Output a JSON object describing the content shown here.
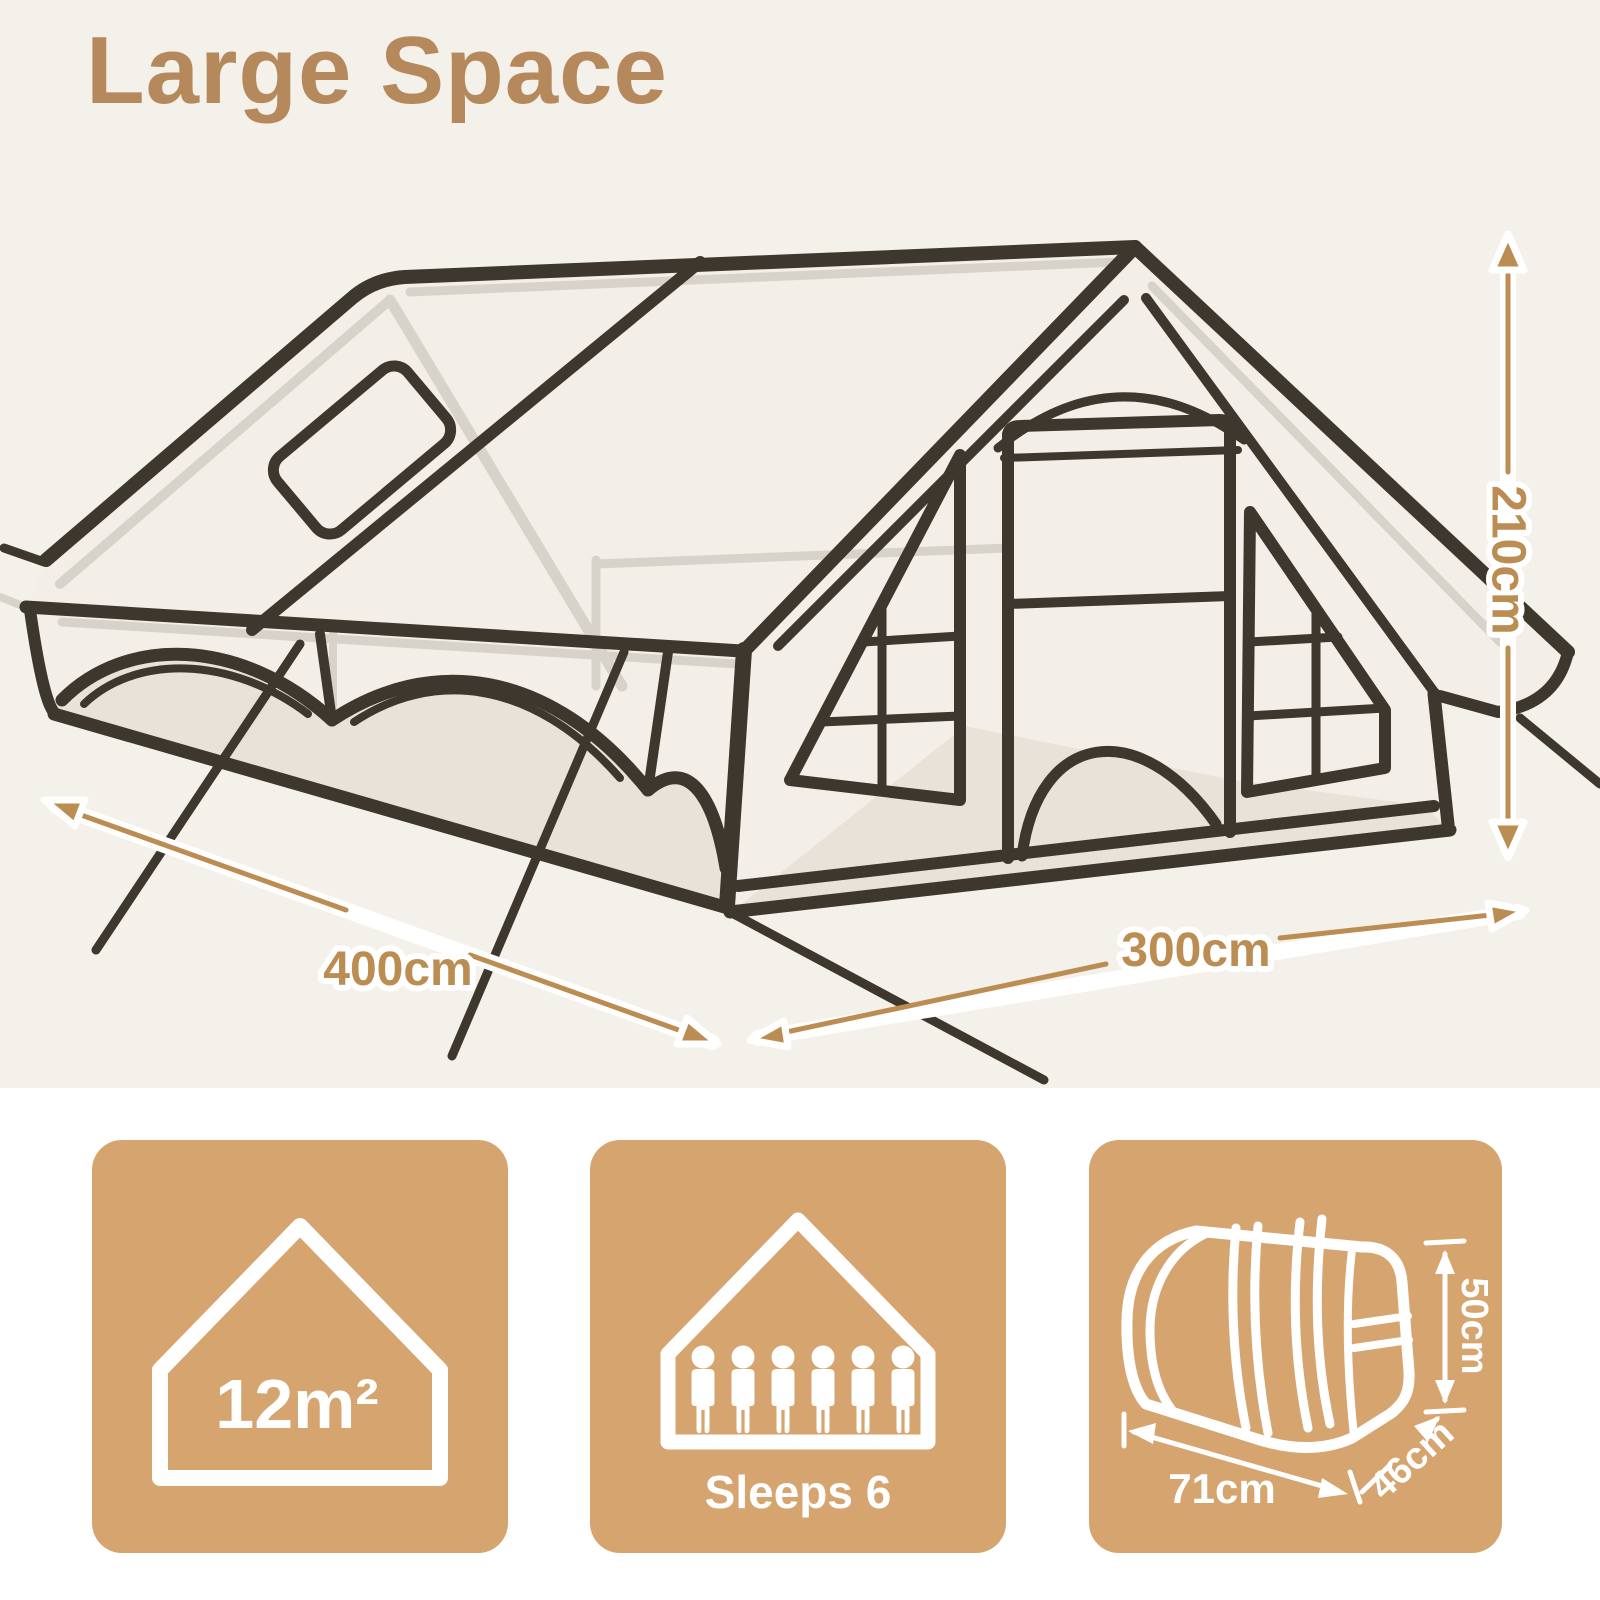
{
  "title": "Large Space",
  "diagram": {
    "height_label": "210cm",
    "width_label": "400cm",
    "depth_label": "300cm"
  },
  "cards": [
    {
      "id": "floor-area",
      "icon": "house-outline-icon",
      "value": "12m²"
    },
    {
      "id": "sleeping-capacity",
      "icon": "house-people-icon",
      "people_count": 6,
      "label": "Sleeps 6"
    },
    {
      "id": "packed-size",
      "icon": "carry-bag-icon",
      "length_label": "71cm",
      "depth_label": "46cm",
      "height_label": "50cm"
    }
  ],
  "colors": {
    "background_top": "#f4f0ea",
    "background_bottom": "#ffffff",
    "card": "#d6a46f",
    "accent_text": "#bc8d52",
    "title_text": "#b5895b",
    "line_dark": "#3e372d",
    "line_gray": "#d8d3ca",
    "shade": "#e9e2d8",
    "icon_white": "#ffffff"
  }
}
